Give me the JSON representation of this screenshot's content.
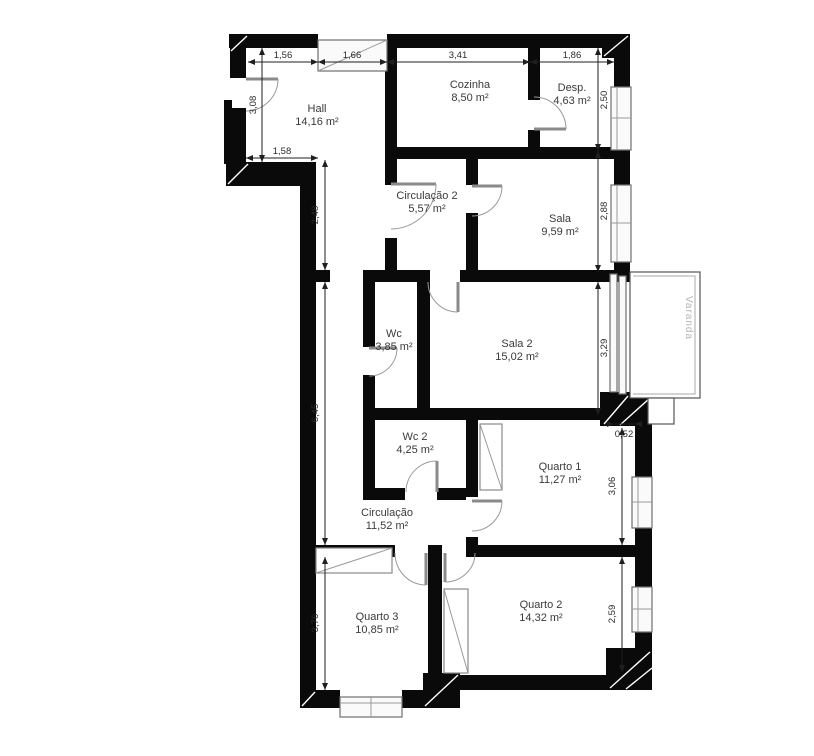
{
  "plan": {
    "rooms": [
      {
        "id": "hall",
        "name": "Hall",
        "area": "14,16 m²"
      },
      {
        "id": "cozinha",
        "name": "Cozinha",
        "area": "8,50 m²"
      },
      {
        "id": "desp",
        "name": "Desp.",
        "area": "4,63 m²"
      },
      {
        "id": "circulacao2",
        "name": "Circulação 2",
        "area": "5,57 m²"
      },
      {
        "id": "sala",
        "name": "Sala",
        "area": "9,59 m²"
      },
      {
        "id": "wc",
        "name": "Wc",
        "area": "3,85 m²"
      },
      {
        "id": "sala2",
        "name": "Sala 2",
        "area": "15,02 m²"
      },
      {
        "id": "wc2",
        "name": "Wc 2",
        "area": "4,25 m²"
      },
      {
        "id": "quarto1",
        "name": "Quarto 1",
        "area": "11,27 m²"
      },
      {
        "id": "circulacao",
        "name": "Circulação",
        "area": "11,52 m²"
      },
      {
        "id": "quarto3",
        "name": "Quarto 3",
        "area": "10,85 m²"
      },
      {
        "id": "quarto2",
        "name": "Quarto 2",
        "area": "14,32 m²"
      }
    ],
    "dims": [
      "1,56",
      "1,66",
      "3,41",
      "1,86",
      "3,08",
      "1,58",
      "2,48",
      "6,45",
      "3,76",
      "2,50",
      "2,88",
      "3,29",
      "0,52",
      "3,06",
      "2,59"
    ],
    "balcony": "Varanda",
    "wall_color": "#0a0a0a",
    "line_color": "#8a8a8a"
  }
}
